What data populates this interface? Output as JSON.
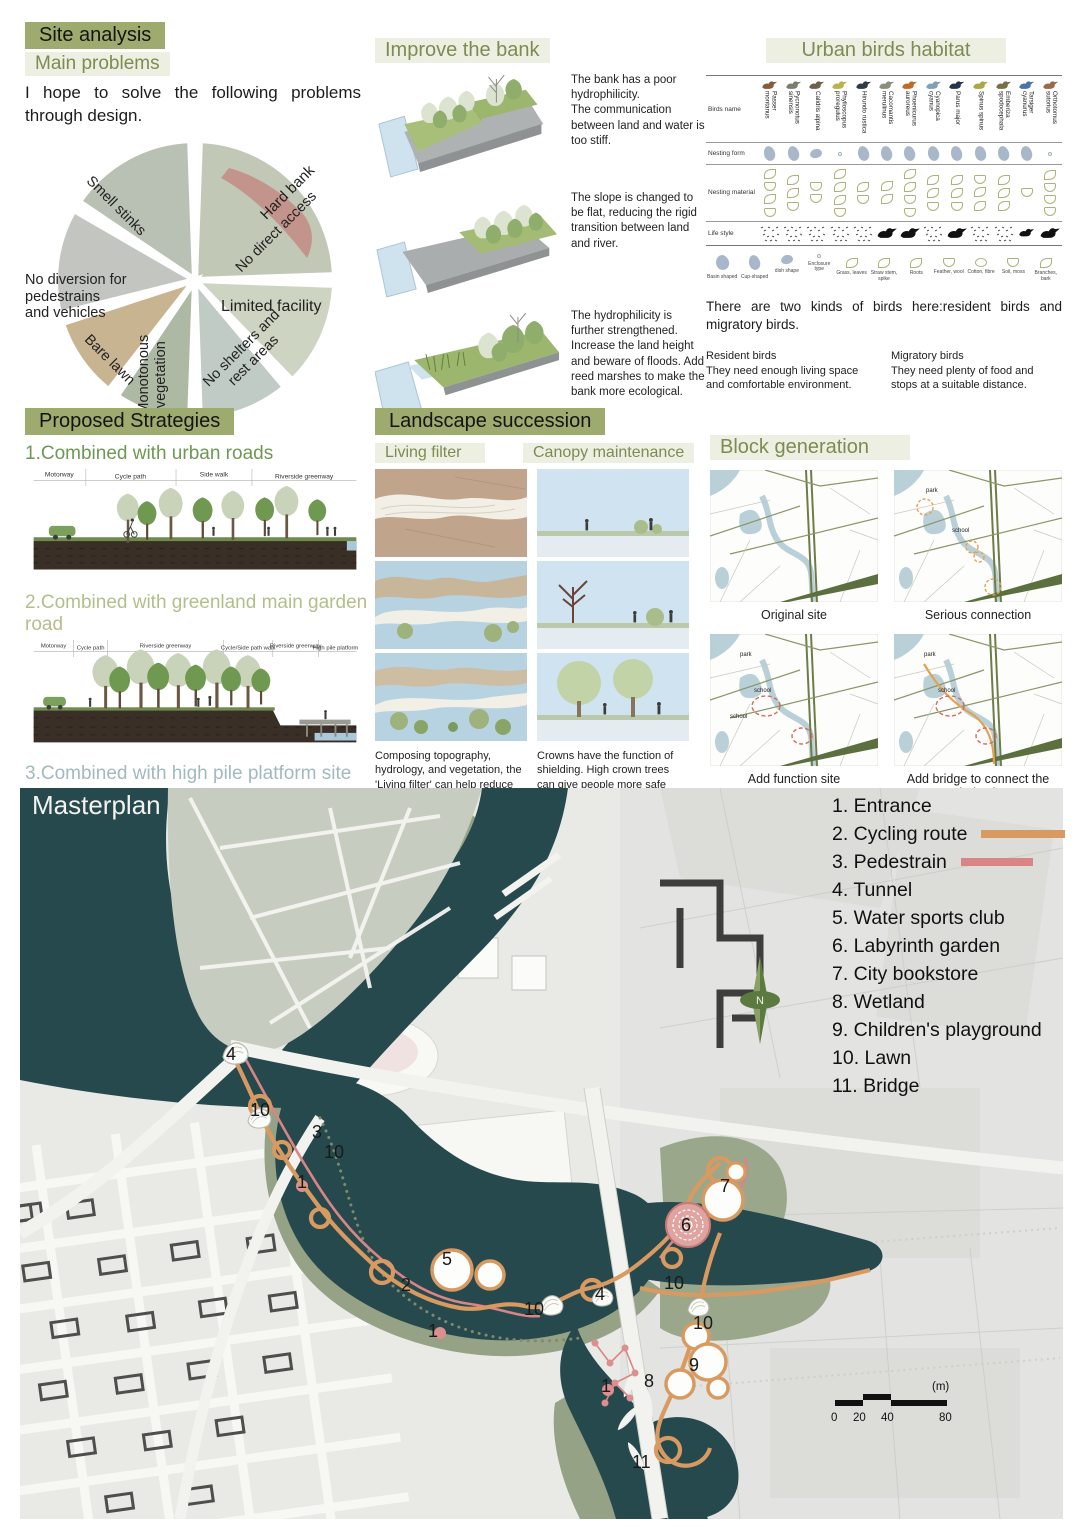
{
  "site_analysis": {
    "title": "Site analysis",
    "subtitle": "Main problems",
    "intro": "I hope to solve the following problems through design.",
    "problems": {
      "smell": "Smell stinks",
      "hard_bank": "Hard bank",
      "no_access": "No direct access",
      "no_diversion": "No diversion for pedestrains\nand vehicles",
      "limited": "Limited facility",
      "bare_lawn": "Bare lawn",
      "monotonous": "Monotonous\nvegetation",
      "no_shelters": "No shelters and\nrest areas"
    }
  },
  "improve_bank": {
    "title": "Improve the bank",
    "step1": "The bank has a poor hydrophilicity.\nThe communication between land and water is too stiff.",
    "step2": "The slope is changed to be flat, reducing the rigid transition between land and river.",
    "step3": "The hydrophilicity is further strengthened. Increase the land height and beware of floods. Add reed marshes to make the bank more ecological."
  },
  "birds": {
    "title": "Urban birds habitat",
    "rows": {
      "name": "Birds name",
      "nesting_form": "Nesting form",
      "nesting_material": "Nesting material",
      "life_style": "Life style"
    },
    "names": [
      "Passer montanus",
      "Pycnonotus sinensis",
      "Calidris alpina",
      "Phylloscopus proregulus",
      "Hirundo rustica",
      "Cacomantis merulinus",
      "Phoenicurus auroreus",
      "Cyanopica cyanus",
      "Parus major",
      "Spinus spinus",
      "Emberiza spodocephala",
      "Tarsiger cyanurus",
      "Orthotomus sutorius"
    ],
    "legend": [
      "Basin shaped",
      "Cup-shaped",
      "dish shape",
      "Enclosure type",
      "Grass, leaves",
      "Straw stem, spike",
      "Roots",
      "Feather, wool",
      "Cotton, fibre",
      "Soil, moss",
      "Branches, bark"
    ],
    "note": "There are two kinds of birds here:resident birds and migratory birds.",
    "resident_title": "Resident birds",
    "resident_text": "They need enough living space and comfortable environment.",
    "migratory_title": "Migratory birds",
    "migratory_text": "They need plenty of food and stops at a suitable distance."
  },
  "strategies": {
    "title": "Proposed Strategies",
    "s1_heading": "1.Combined with urban roads",
    "s1_labels": [
      "Motorway",
      "Cycle path",
      "Side walk",
      "Riverside greenway"
    ],
    "s2_heading": "2.Combined with greenland main garden road",
    "s2_labels": [
      "Motorway",
      "Cycle path",
      "Riverside greenway",
      "Cycle/Side path walk",
      "Riverside greenway",
      "High pile platform"
    ],
    "s3_heading": "3.Combined with high pile platform site",
    "s3_labels": [
      "Motorway",
      "Cycle path",
      "Riverside greenway",
      "side walk",
      "Riverside greenway",
      "Cycle path",
      "High pile platform"
    ]
  },
  "succession": {
    "title": "Landscape succession",
    "living_filter": "Living filter",
    "canopy": "Canopy maintenance",
    "living_caption": "Composing topography, hydrology, and vegetation, the 'Living filter' can help reduce the peculiar smell of the lake.",
    "canopy_caption": "Crowns have the function of shielding. High crown trees can give people more safe feelings."
  },
  "block_generation": {
    "title": "Block generation",
    "captions": [
      "Original site",
      "Serious connection",
      "Add function site",
      "Add bridge to connect the whole site"
    ],
    "park_label": "park",
    "school_label": "school"
  },
  "masterplan": {
    "title": "Masterplan",
    "legend": [
      "1. Entrance",
      "2. Cycling route",
      "3. Pedestrain",
      "4. Tunnel",
      "5. Water sports club",
      "6. Labyrinth garden",
      "7. City bookstore",
      "8. Wetland",
      "9. Children's playground",
      "10. Lawn",
      "11. Bridge"
    ],
    "colors": {
      "cycling": "#D99A62",
      "pedestrian": "#D98585",
      "water": "#26494E"
    },
    "north_label": "N",
    "scale_ticks": [
      "0",
      "20",
      "40",
      "80"
    ],
    "scale_unit": "(m)",
    "markers": [
      "4",
      "10",
      "3",
      "10",
      "1",
      "5",
      "2",
      "10",
      "1",
      "4",
      "10",
      "7",
      "6",
      "10",
      "9",
      "8",
      "1",
      "11"
    ]
  }
}
